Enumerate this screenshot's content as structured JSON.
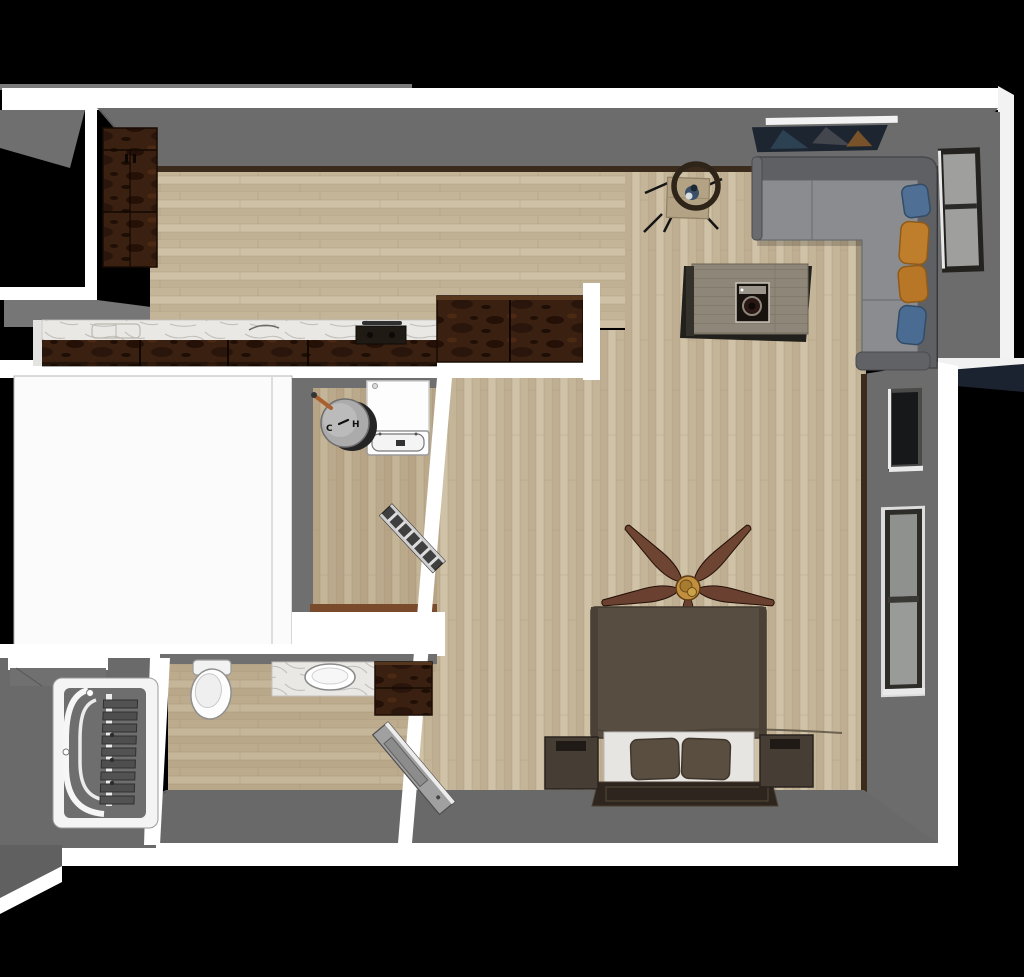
{
  "scene": {
    "type": "3d-floorplan-render",
    "view": "top-down perspective",
    "description": "Rendered overhead view of a studio apartment with open kitchen/living area, bedroom zone, bathroom, laundry room, stairwell and an unfinished white room",
    "background": "#000000"
  },
  "labels": {
    "cold": "C",
    "hot": "H"
  },
  "palette": {
    "background": "#000000",
    "outer_wall_white": "#ffffff",
    "interior_wall_gray": "#6c6c6c",
    "bottom_wall_gray": "#696969",
    "floor_wood": "#cabb9f",
    "floor_wood_tint": "#8a6a42",
    "baseboard_brown": "#3a2b1d",
    "cabinet_wood_dark": "#3a2010",
    "marble_counter": "#eae8e4",
    "cooktop_black": "#201a15",
    "sofa_back": "#5f6064",
    "sofa_seat": "#8b8c90",
    "pillow_blue": "#4f6f95",
    "pillow_mustard": "#bf7e2b",
    "wall_art_navy": "#1d2531",
    "coffee_table_top": "#8e8678",
    "bistro_table_wood": "#b3a284",
    "ring_chair": "#2f2418",
    "vase_navy": "#3b5068",
    "bed_duvet": "#584d41",
    "bed_sheet": "#e6e5e2",
    "bed_pillow": "#5a4e40",
    "headboard": "#2e261e",
    "nightstand": "#463e35",
    "fan_blade": "#6e4432",
    "fan_hub_brass": "#c18f3e",
    "stair_step": "#525252",
    "door_leaf": "#a0a0a0",
    "window_glass": "#9fa09e",
    "window_glass_dark": "#17181a",
    "window_frame": "#2e2c29",
    "roof_navy": "#1b2230",
    "copper_pipe": "#a95f2e",
    "appliance_white": "#fdfdfd",
    "utility_sink_gray": "#ababab"
  },
  "rooms": [
    {
      "name": "kitchen",
      "items": [
        "tall-pantry-cabinet",
        "base-cabinets",
        "marble-countertop",
        "sink",
        "cooktop",
        "corner-cabinet"
      ]
    },
    {
      "name": "living-area",
      "items": [
        "sectional-sofa",
        "throw-pillows",
        "coffee-table",
        "record-player",
        "wall-art",
        "bistro-table",
        "ring-chair",
        "vase",
        "window"
      ]
    },
    {
      "name": "bedroom-area",
      "items": [
        "bed",
        "pillows",
        "headboard",
        "nightstand-left",
        "nightstand-right",
        "ceiling-fan",
        "upper-window",
        "lower-window"
      ]
    },
    {
      "name": "laundry-room",
      "items": [
        "washing-machine",
        "utility-sink",
        "hot-cold-valves",
        "copper-pipe",
        "drying-rack",
        "threshold"
      ]
    },
    {
      "name": "bathroom",
      "items": [
        "toilet",
        "vanity-with-sink",
        "storage-cabinet",
        "open-door"
      ]
    },
    {
      "name": "stairwell",
      "items": [
        "staircase-steps",
        "curved-railing",
        "landing-ledge"
      ]
    },
    {
      "name": "unfinished-room",
      "items": []
    }
  ],
  "pillows": {
    "count": 4,
    "colors": [
      "blue",
      "mustard",
      "mustard",
      "blue"
    ]
  },
  "fan": {
    "blade_count": 5
  }
}
